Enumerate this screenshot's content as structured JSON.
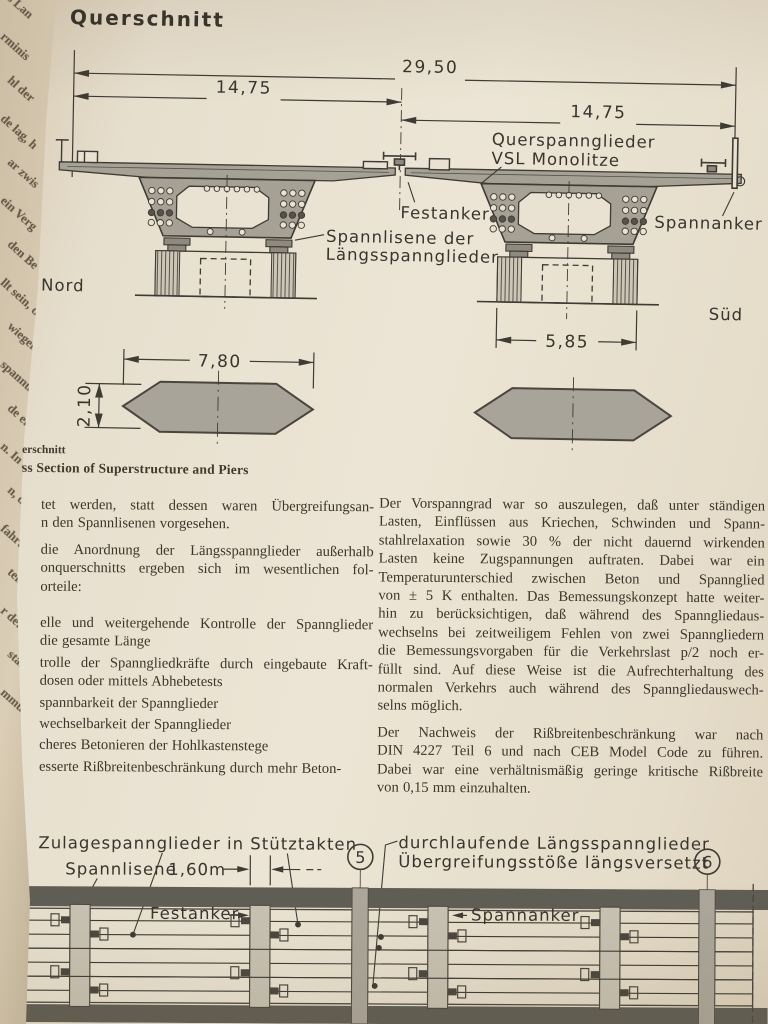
{
  "figure_top": {
    "title": "Querschnitt",
    "dim_total": "29,50",
    "dim_half_left": "14,75",
    "dim_half_right": "14,75",
    "dim_pier_gap": "5,85",
    "dim_pier_len": "7,80",
    "dim_pier_thk": "2,10",
    "label_transverse_1": "Querspannglieder",
    "label_transverse_2": "VSL Monolitze",
    "label_fixed_anchor": "Festanker",
    "label_stress_anchor": "Spannanker",
    "label_lisene_1": "Spannlisene der",
    "label_lisene_2": "Längsspannglieder",
    "label_north": "Nord",
    "label_south": "Süd",
    "caption_de": "erschnitt",
    "caption_en": "ss Section of Superstructure and Piers"
  },
  "spine_fragments": [
    "s Lan",
    "rminis",
    "hl der",
    "de lag, h",
    "ar zwis",
    "ein Verg",
    "den Be",
    "llt sein, d",
    "wiegend",
    "spannu",
    "de erte",
    "n. In er",
    "n, daß",
    "fahrung",
    "tellen",
    "r der S",
    "stahl",
    "mmung"
  ],
  "text_columns": {
    "left": {
      "para1": [
        "tet werden, statt dessen waren Übergreifungsan-",
        "n den Spannlisenen vorgesehen."
      ],
      "para2": [
        "die Anordnung der Längsspannglieder außerhalb",
        "onquerschnitts ergeben sich im wesentlichen fol-",
        "orteile:"
      ],
      "item1": [
        "elle und weitergehende Kontrolle der Spannglieder",
        "die gesamte Länge"
      ],
      "item2": [
        "trolle der Spanngliedkräfte durch eingebaute Kraft-",
        "dosen oder mittels Abhebetests"
      ],
      "item3": [
        "spannbarkeit der Spannglieder"
      ],
      "item4": [
        "wechselbarkeit der Spannglieder"
      ],
      "item5": [
        "cheres Betonieren der Hohlkastenstege"
      ],
      "item6": [
        "esserte Rißbreitenbeschränkung durch mehr Beton-"
      ]
    },
    "right": {
      "para1": [
        "Der Vorspanngrad war so auszulegen, daß unter ständigen",
        "Lasten, Einflüssen aus Kriechen, Schwinden und Spann-",
        "stahlrelaxation sowie 30 % der nicht dauernd wirkenden",
        "Lasten keine Zugspannungen auftraten. Dabei war ein",
        "Temperaturunterschied zwischen Beton und Spannglied",
        "von ± 5 K enthalten. Das Bemessungskonzept hatte weiter-",
        "hin zu berücksichtigen, daß während des Spanngliedaus-",
        "wechselns bei zeitweiligem Fehlen von zwei Spanngliedern",
        "die Bemessungsvorgaben für die Verkehrslast p/2 noch er-",
        "füllt sind. Auf diese Weise ist die Aufrechterhaltung des",
        "normalen Verkehrs auch während des Spanngliedauswech-",
        "selns möglich."
      ],
      "para2": [
        "Der Nachweis der Rißbreitenbeschränkung war nach",
        "DIN 4227 Teil 6 und nach CEB Model Code zu führen.",
        "Dabei war eine verhältnismäßig geringe kritische Rißbreite",
        "von 0,15 mm einzuhalten."
      ]
    }
  },
  "figure_bottom": {
    "label_zulage": "Zulagespannglieder in Stütztakten",
    "label_lisene": "Spannlisene",
    "dim_lisene": "1,60m",
    "label_continuous_1": "durchlaufende Längsspannglieder",
    "label_continuous_2": "Übergreifungsstöße längsversetzt",
    "axis_5": "5",
    "axis_6": "6",
    "label_fixed_anchor": "Festanker",
    "label_stress_anchor": "Spannanker",
    "cut_circle_fragment": ")"
  }
}
